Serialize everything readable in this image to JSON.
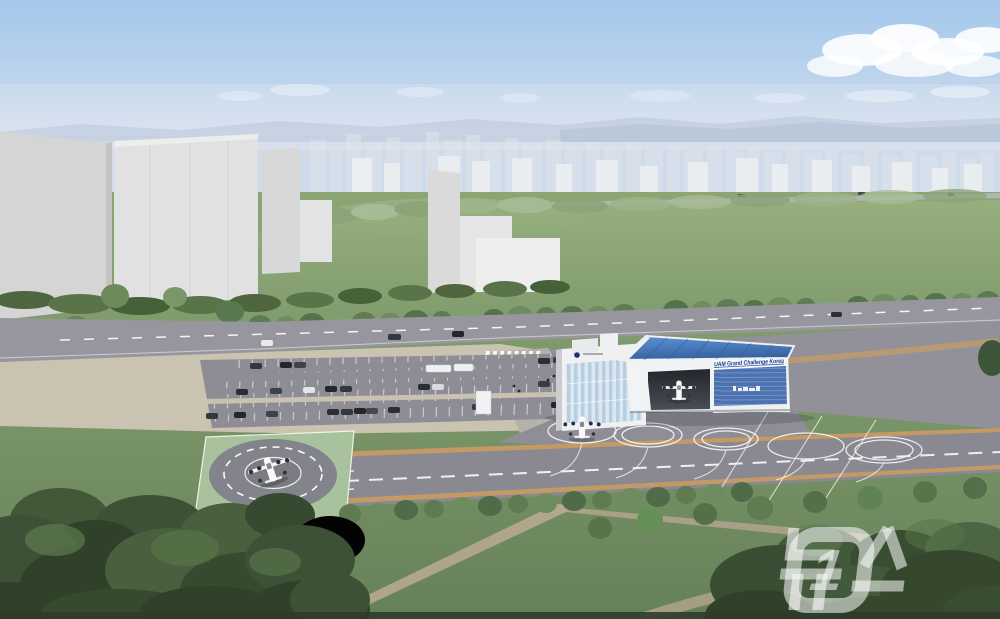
{
  "scene": {
    "type": "architectural-rendering",
    "subject": "Aerial concept rendering of a UAM (urban air mobility) vertiport test facility with hangar, apron stand circles, runway strip, helipad, parking lot, surrounding park and a city skyline in the background"
  },
  "hangar": {
    "sign_text": "UAM Grand Challenge Korea"
  },
  "watermark": {
    "text": "뉴스",
    "badge": "1",
    "full": "뉴스1"
  },
  "colors": {
    "sky_top": "#a4c8eb",
    "sky_horizon": "#d9e0ec",
    "city_haze": "#e4e8ee",
    "meadow_green": "#87a274",
    "grass_dark": "#6d8859",
    "tree_dark": "#3c5136",
    "road_gray": "#97969e",
    "pavement_gray": "#92919a",
    "runway_gray": "#8a8992",
    "runway_stripe": "#c99c62",
    "plaza_tan": "#cac3b1",
    "hangar_roof_blue": "#4a7ec6",
    "hangar_panel_blue": "#4c72b2",
    "sign_navy": "#16398e",
    "building_white": "#eef0f2",
    "glass_blue": "#b7cde0",
    "helipad_green": "#a9c49e",
    "marking_white": "#f4f5f4",
    "watermark_white": "rgba(255,255,255,0.55)"
  }
}
